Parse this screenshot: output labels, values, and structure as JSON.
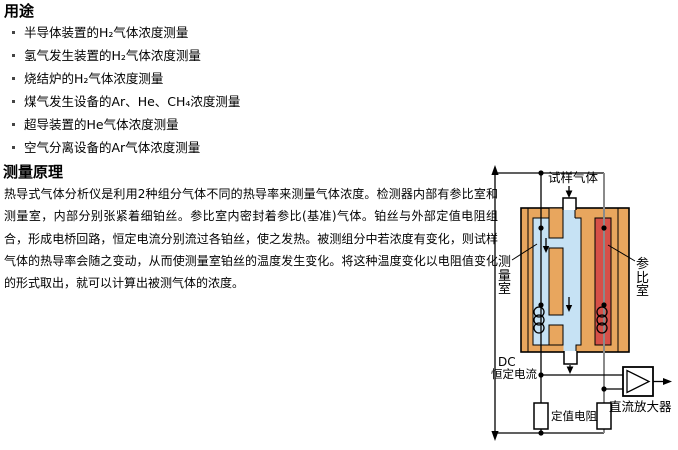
{
  "applications": {
    "title": "用途",
    "items": [
      "半导体装置的H₂气体浓度测量",
      "氢气发生装置的H₂气体浓度测量",
      "烧结炉的H₂气体浓度测量",
      "煤气发生设备的Ar、He、CH₄浓度测量",
      "超导装置的He气体浓度测量",
      "空气分离设备的Ar气体浓度测量"
    ]
  },
  "principle": {
    "title": "测量原理",
    "body": "热导式气体分析仪是利用2种组分气体不同的热导率来测量气体浓度。检测器内部有参比室和测量室，内部分别张紧着细铂丝。参比室内密封着参比(基准)气体。铂丝与外部定值电阻组合，形成电桥回路，恒定电流分别流过各铂丝，使之发热。被测组分中若浓度有变化，则试样气体的热导率会随之变动，从而使测量室铂丝的温度发生变化。将这种温度变化以电阻值变化的形式取出，就可以计算出被测气体的浓度。"
  },
  "diagram": {
    "labels": {
      "sample_gas": "试样气体",
      "measuring_chamber": "测量室",
      "reference_chamber": "参比室",
      "dc": "DC",
      "constant_current": "恒定电流",
      "fixed_resistor": "定值电阻",
      "dc_amplifier": "直流放大器"
    },
    "colors": {
      "block": "#e8a65e",
      "sample_path": "#c6e2f4",
      "reference_gas": "#d65048",
      "wire": "#000000",
      "reference_wire": "#8a8a8a"
    }
  }
}
